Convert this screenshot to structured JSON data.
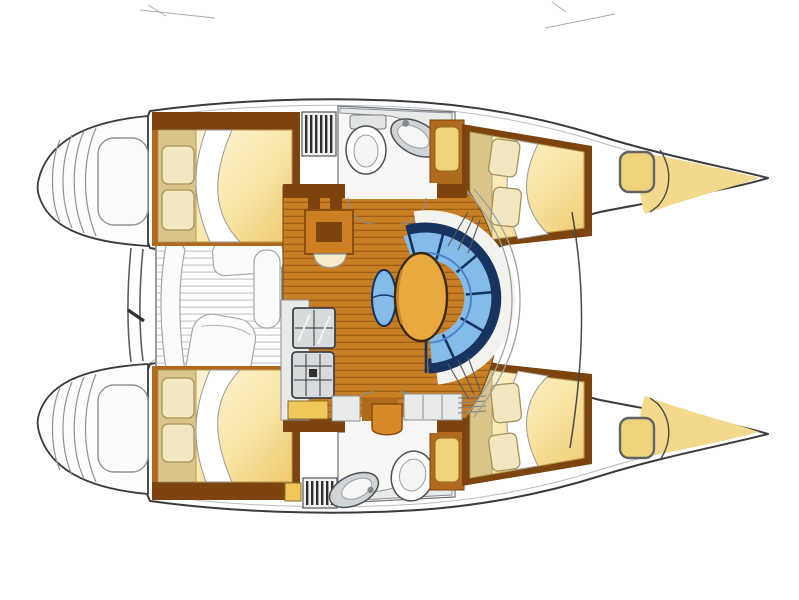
{
  "diagram": {
    "type": "boat-floor-plan",
    "subject": "catamaran-interior-layout",
    "areas": [
      {
        "id": "port-stern-platform",
        "label": "stern transom with boarding steps"
      },
      {
        "id": "starboard-stern-platform",
        "label": "stern transom with boarding steps"
      },
      {
        "id": "aft-crossbeam",
        "label": "aft crossbeam between hulls"
      },
      {
        "id": "cockpit",
        "label": "aft cockpit with slatted floor and seat cushions"
      },
      {
        "id": "saloon",
        "label": "bridgedeck saloon with wood plank floor"
      },
      {
        "id": "chart-table",
        "label": "chart table with stool"
      },
      {
        "id": "dinette",
        "label": "curved blue settee with oval table and stool"
      },
      {
        "id": "galley",
        "label": "galley with double sink, stove and cabinets"
      },
      {
        "id": "port-aft-cabin",
        "label": "double berth with pillows"
      },
      {
        "id": "port-head",
        "label": "head compartment with toilet and basin"
      },
      {
        "id": "port-forward-cabin",
        "label": "double berth with pillows"
      },
      {
        "id": "port-bow-locker",
        "label": "bow anchor locker with deck hatch"
      },
      {
        "id": "starboard-aft-cabin",
        "label": "double berth with pillows"
      },
      {
        "id": "starboard-head",
        "label": "head compartment with toilet and basin"
      },
      {
        "id": "starboard-forward-cabin",
        "label": "double berth with pillows"
      },
      {
        "id": "starboard-bow-locker",
        "label": "bow anchor locker with deck hatch"
      },
      {
        "id": "companionway-steps",
        "label": "companionway steps into each hull"
      },
      {
        "id": "forestay",
        "label": "forestay bridle line between bows"
      }
    ],
    "palette": {
      "hull_outline": "#3b3b3b",
      "wood_floor": "#c87e22",
      "wood_floor_line": "#a05f16",
      "wood_dark": "#7d4410",
      "wood_mid": "#b06a1e",
      "wood_table": "#cd7f22",
      "bed_tan": "#d9c48a",
      "bed_light": "#fdf4d6",
      "bed_gold": "#f0c96a",
      "pillow": "#f2e7c0",
      "pillow_edge": "#a8925a",
      "sofa_light": "#85bbe9",
      "sofa_mid": "#4a86c8",
      "sofa_navy": "#17335f",
      "settee_base": "#f2f2ee",
      "table_orange": "#e9a93e",
      "table_edge": "#3a2a10",
      "stool_cream": "#f7edc9",
      "bow_yellow": "#f3d98b",
      "hatch_yellow": "#f0d27a",
      "counter": "#e9ebea",
      "counter_edge": "#8a8f94",
      "fixture": "#d8dbdc",
      "slat_line": "#c9c9c9",
      "cushion": "#fbfbfb",
      "cushion_edge": "#a8a8a8",
      "cabinet_yellow": "#f0c75a",
      "cabinet_orange": "#d88a28"
    }
  }
}
